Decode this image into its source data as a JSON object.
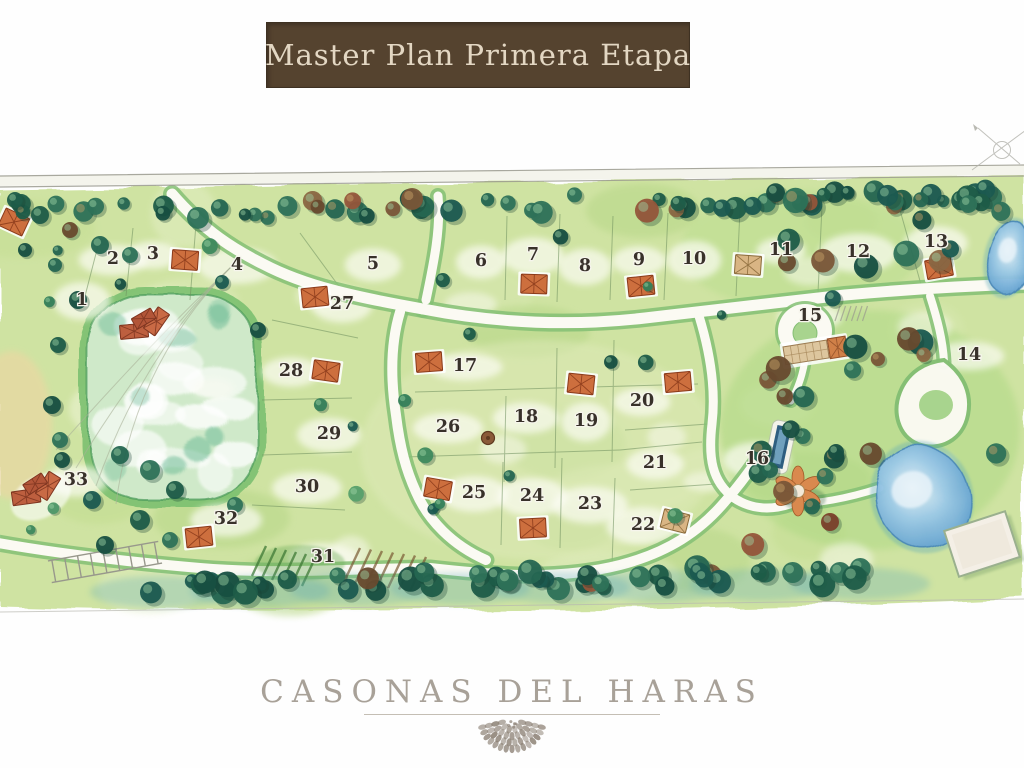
{
  "banner": {
    "title": "Master Plan Primera Etapa"
  },
  "brand": {
    "wordmark": "CASONAS DEL HARAS"
  },
  "map": {
    "description": "Watercolor master plan site map with numbered residential lots, lake, roads, ponds and club area",
    "lots": [
      {
        "number": "1",
        "x": 82,
        "y": 299
      },
      {
        "number": "2",
        "x": 113,
        "y": 258
      },
      {
        "number": "3",
        "x": 153,
        "y": 253
      },
      {
        "number": "4",
        "x": 237,
        "y": 264
      },
      {
        "number": "5",
        "x": 373,
        "y": 263
      },
      {
        "number": "6",
        "x": 481,
        "y": 260
      },
      {
        "number": "7",
        "x": 533,
        "y": 254
      },
      {
        "number": "8",
        "x": 585,
        "y": 265
      },
      {
        "number": "9",
        "x": 639,
        "y": 259
      },
      {
        "number": "10",
        "x": 694,
        "y": 258
      },
      {
        "number": "11",
        "x": 781,
        "y": 249
      },
      {
        "number": "12",
        "x": 858,
        "y": 251
      },
      {
        "number": "13",
        "x": 936,
        "y": 241
      },
      {
        "number": "14",
        "x": 969,
        "y": 354
      },
      {
        "number": "15",
        "x": 810,
        "y": 315
      },
      {
        "number": "16",
        "x": 757,
        "y": 458
      },
      {
        "number": "17",
        "x": 465,
        "y": 365
      },
      {
        "number": "18",
        "x": 526,
        "y": 416
      },
      {
        "number": "19",
        "x": 586,
        "y": 420
      },
      {
        "number": "20",
        "x": 642,
        "y": 400
      },
      {
        "number": "21",
        "x": 655,
        "y": 462
      },
      {
        "number": "22",
        "x": 643,
        "y": 524
      },
      {
        "number": "23",
        "x": 590,
        "y": 503
      },
      {
        "number": "24",
        "x": 532,
        "y": 495
      },
      {
        "number": "25",
        "x": 474,
        "y": 492
      },
      {
        "number": "26",
        "x": 448,
        "y": 426
      },
      {
        "number": "27",
        "x": 342,
        "y": 303
      },
      {
        "number": "28",
        "x": 291,
        "y": 370
      },
      {
        "number": "29",
        "x": 329,
        "y": 433
      },
      {
        "number": "30",
        "x": 307,
        "y": 486
      },
      {
        "number": "31",
        "x": 323,
        "y": 556
      },
      {
        "number": "32",
        "x": 226,
        "y": 518
      },
      {
        "number": "33",
        "x": 76,
        "y": 479
      }
    ],
    "features": {
      "lake": {
        "x": 88,
        "y": 294,
        "w": 168,
        "h": 206
      },
      "ponds": [
        {
          "x": 922,
          "y": 497,
          "rx": 46,
          "ry": 52,
          "rot": -20
        },
        {
          "x": 1009,
          "y": 258,
          "rx": 20,
          "ry": 36,
          "rot": 12
        }
      ],
      "pool": {
        "x": 780,
        "y": 447,
        "rot": 12
      },
      "arena": {
        "x": 982,
        "y": 544,
        "w": 64,
        "h": 48,
        "rot": -18
      },
      "clubhouse": {
        "x": 798,
        "y": 491
      },
      "roundabout": {
        "x": 805,
        "y": 331
      },
      "teardrop": {
        "x": 938,
        "y": 403
      },
      "hut": {
        "x": 488,
        "y": 438
      },
      "houses": [
        {
          "x": 14,
          "y": 222,
          "rot": 25,
          "kind": "orange"
        },
        {
          "x": 148,
          "y": 330,
          "rot": -25,
          "kind": "estate"
        },
        {
          "x": 185,
          "y": 260,
          "rot": 4,
          "kind": "orange"
        },
        {
          "x": 315,
          "y": 297,
          "rot": -6,
          "kind": "orange"
        },
        {
          "x": 326,
          "y": 371,
          "rot": 8,
          "kind": "orange"
        },
        {
          "x": 429,
          "y": 362,
          "rot": -4,
          "kind": "orange"
        },
        {
          "x": 534,
          "y": 284,
          "rot": 2,
          "kind": "orange"
        },
        {
          "x": 641,
          "y": 286,
          "rot": -6,
          "kind": "orange"
        },
        {
          "x": 748,
          "y": 265,
          "rot": 4,
          "kind": "tan"
        },
        {
          "x": 939,
          "y": 268,
          "rot": -10,
          "kind": "orange"
        },
        {
          "x": 581,
          "y": 384,
          "rot": 6,
          "kind": "orange"
        },
        {
          "x": 678,
          "y": 382,
          "rot": -5,
          "kind": "orange"
        },
        {
          "x": 438,
          "y": 489,
          "rot": 10,
          "kind": "orange"
        },
        {
          "x": 533,
          "y": 528,
          "rot": -3,
          "kind": "orange"
        },
        {
          "x": 675,
          "y": 521,
          "rot": 14,
          "kind": "tan"
        },
        {
          "x": 199,
          "y": 537,
          "rot": -6,
          "kind": "orange"
        },
        {
          "x": 40,
          "y": 495,
          "rot": -28,
          "kind": "estate"
        },
        {
          "x": 815,
          "y": 351,
          "rot": -9,
          "kind": "hacienda"
        }
      ]
    },
    "colors": {
      "banner_bg": "#55432f",
      "banner_text": "#e3d7c3",
      "paper": "#fefefe",
      "grass": "#cfe3a2",
      "grass_light": "#e4efc6",
      "verge": "#84bf74",
      "road": "#fbfaf3",
      "tree_dark": "#1e5c48",
      "tree_mid": "#3f8a5e",
      "tree_brown": "#7a5638",
      "lake_rim": "#4a9a5a",
      "lake_fill": "#d9efdb",
      "water": "#7db7e0",
      "roof_orange": "#cd6f3e",
      "roof_tan": "#d9b584",
      "number_ink": "#38312a",
      "brand_text": "#a8a198"
    }
  }
}
